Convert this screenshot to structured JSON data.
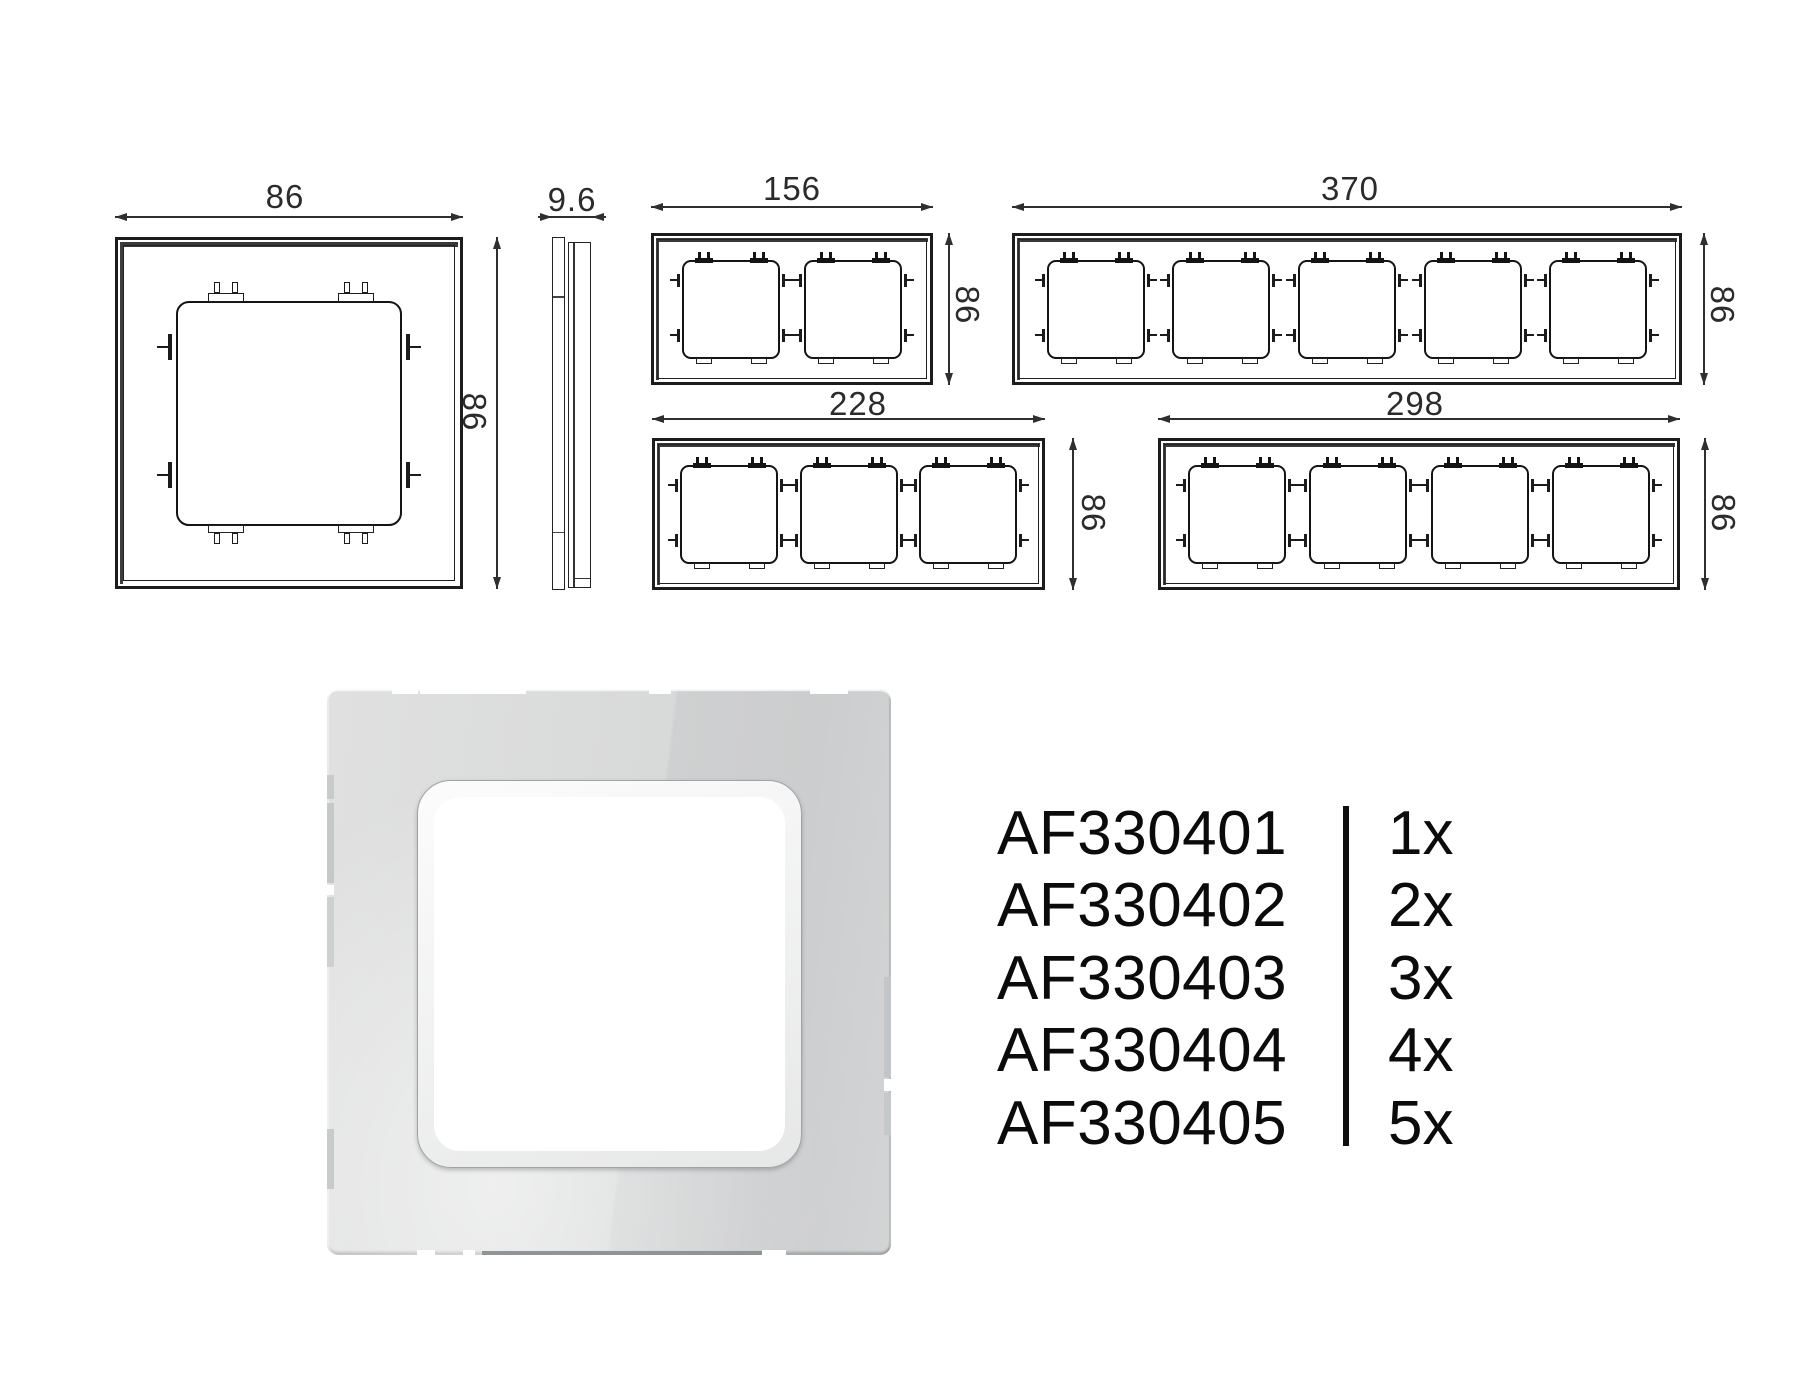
{
  "colors": {
    "ink": "#1c1c1c",
    "dimension": "#2f2f2f",
    "text": "#0b0b0b",
    "glass_light": "#dcdddd",
    "glass_dark": "#cfd1d2",
    "ring": "#f2f3f3"
  },
  "drawings": {
    "frames": [
      {
        "name": "frame-1gang",
        "gangs": 1,
        "width_label": "86",
        "height_label": "86"
      },
      {
        "name": "frame-2gang",
        "gangs": 2,
        "width_label": "156",
        "height_label": "86"
      },
      {
        "name": "frame-5gang",
        "gangs": 5,
        "width_label": "370",
        "height_label": "86"
      },
      {
        "name": "frame-3gang",
        "gangs": 3,
        "width_label": "228",
        "height_label": "86"
      },
      {
        "name": "frame-4gang",
        "gangs": 4,
        "width_label": "298",
        "height_label": "86"
      }
    ],
    "profile": {
      "name": "frame-side-profile",
      "depth_label": "9.6"
    }
  },
  "products": [
    {
      "code": "AF330401",
      "qty": "1x"
    },
    {
      "code": "AF330402",
      "qty": "2x"
    },
    {
      "code": "AF330403",
      "qty": "3x"
    },
    {
      "code": "AF330404",
      "qty": "4x"
    },
    {
      "code": "AF330405",
      "qty": "5x"
    }
  ]
}
